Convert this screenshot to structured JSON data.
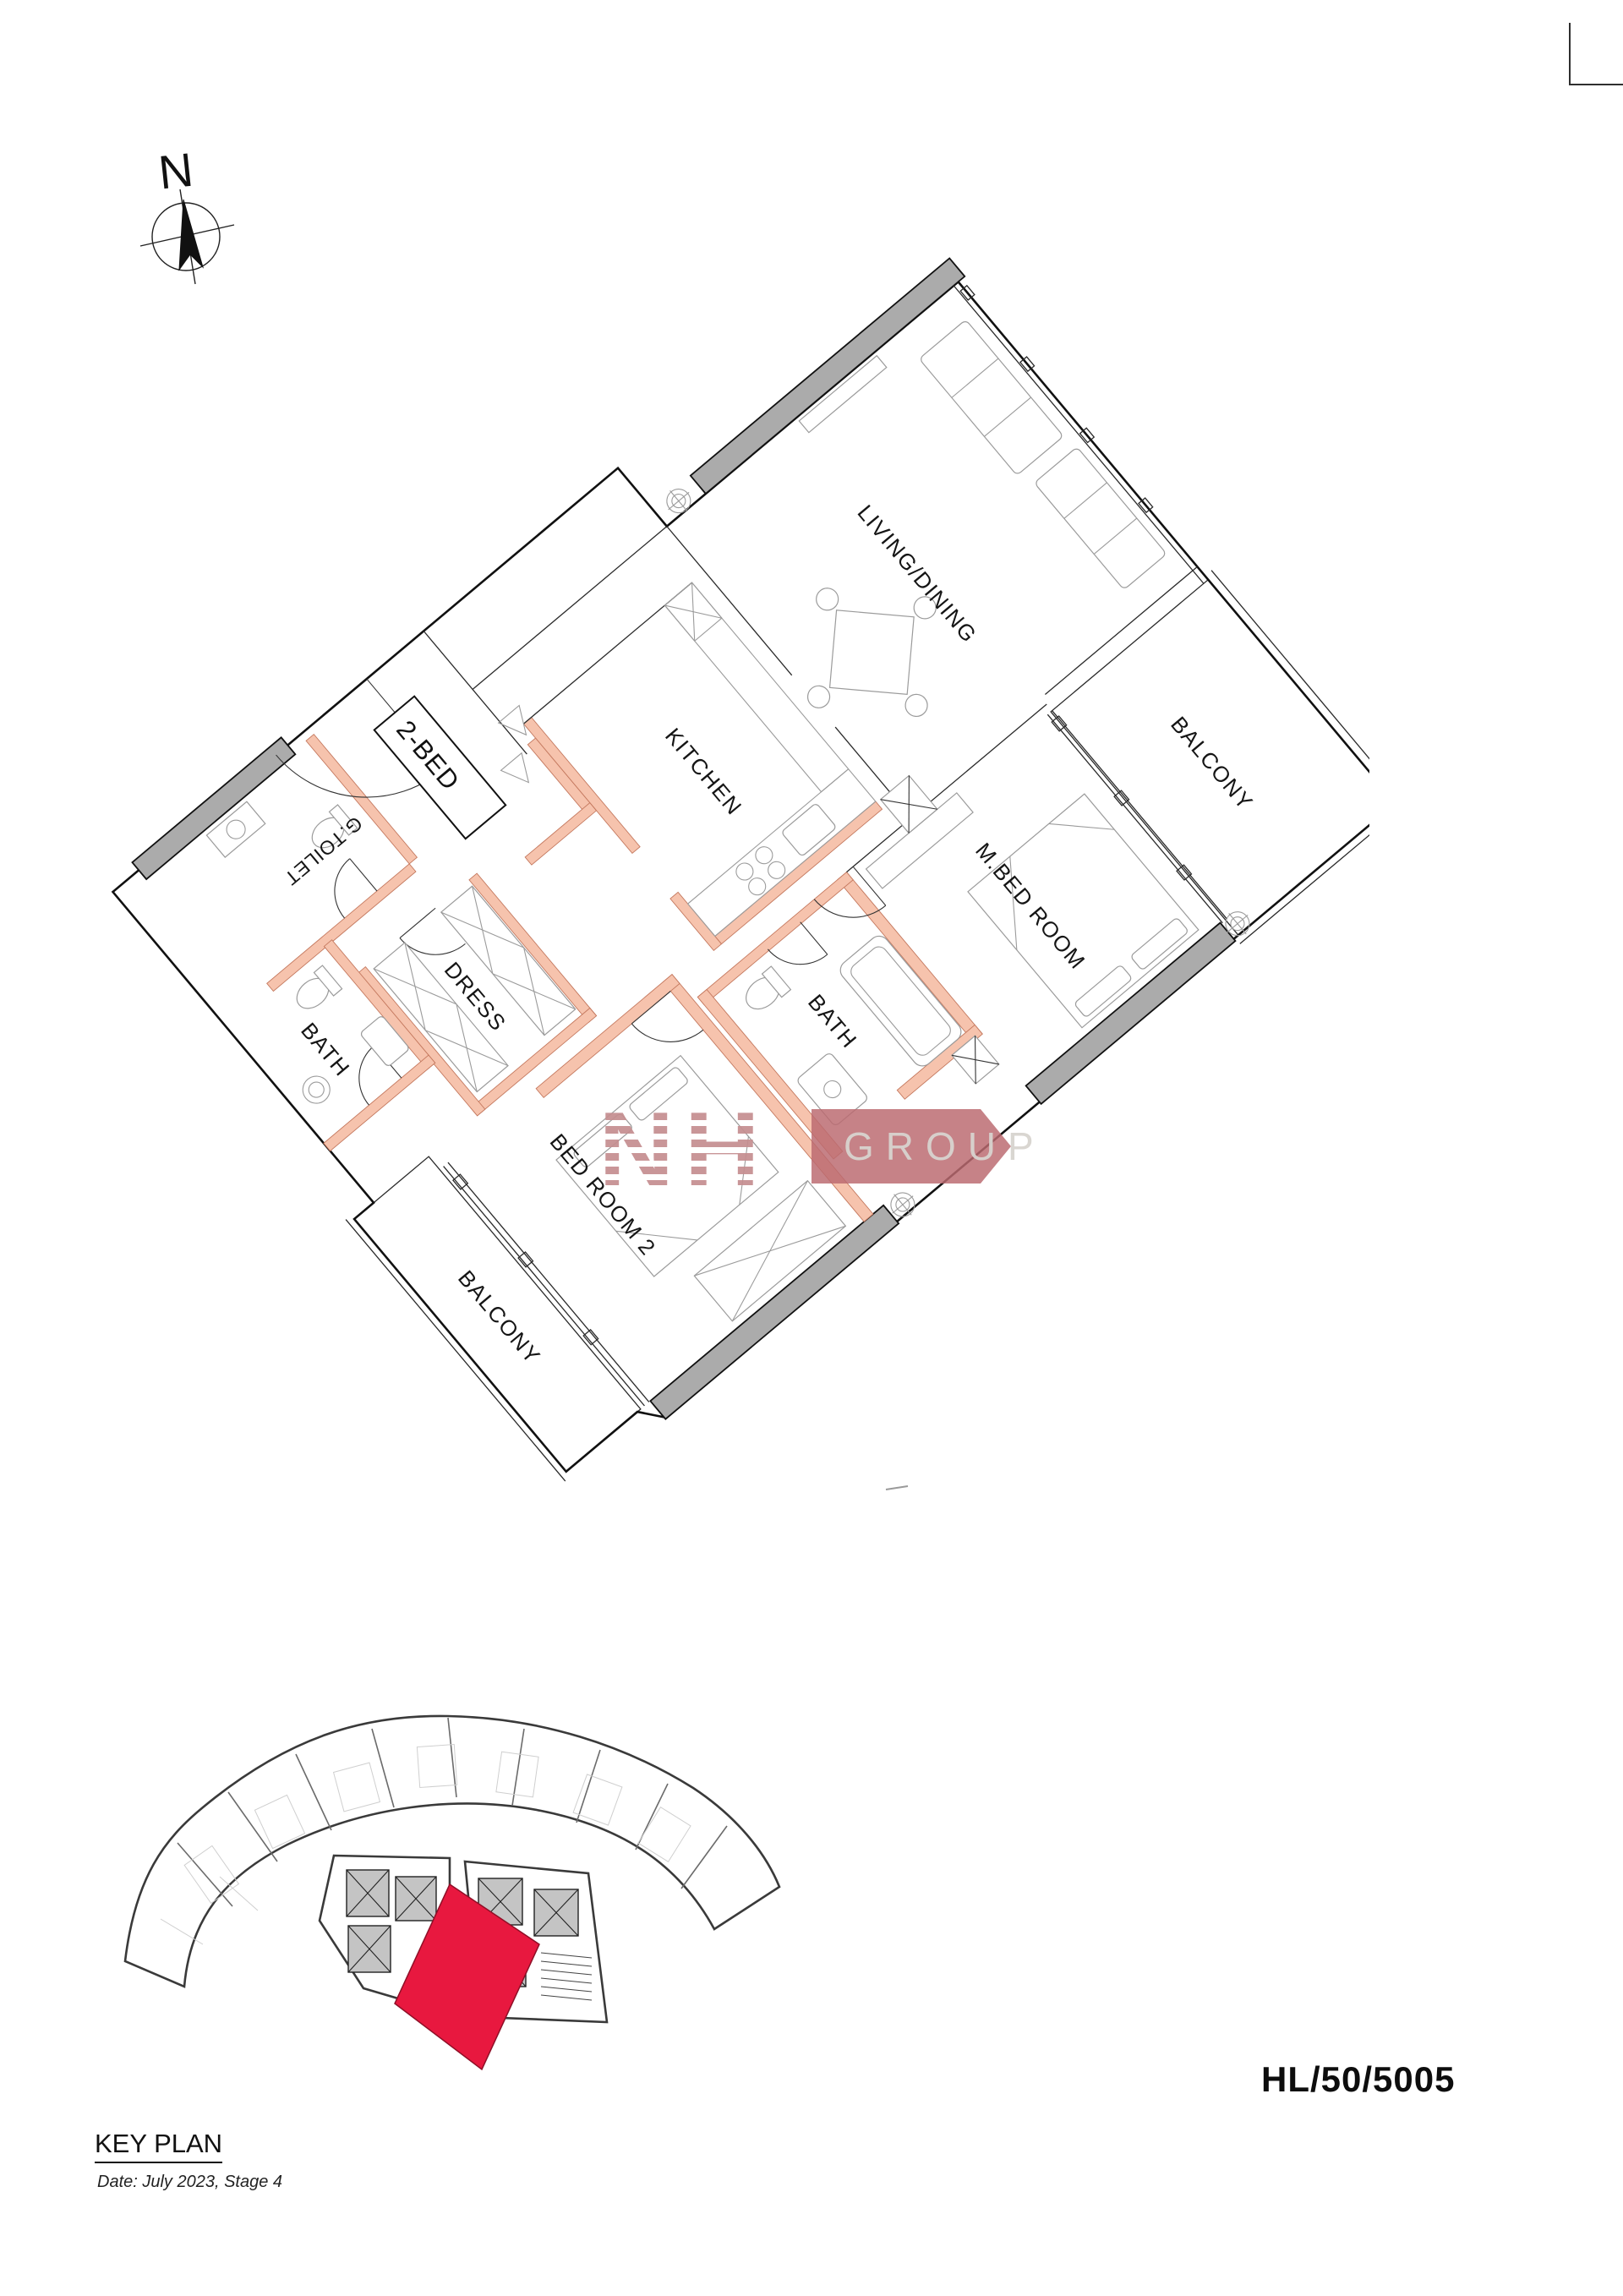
{
  "document": {
    "unit_code": "HL/50/5005",
    "key_plan_title": "KEY PLAN",
    "key_plan_date": "Date: July 2023, Stage 4"
  },
  "compass": {
    "label": "N"
  },
  "floor_plan": {
    "unit_type_label": "2-BED",
    "room_labels": {
      "living_dining": "LIVING/DINING",
      "kitchen": "KITCHEN",
      "master_bedroom": "M.BED ROOM",
      "balcony_right": "BALCONY",
      "master_bath": "BATH",
      "dress": "DRESS",
      "guest_toilet": "G.TOILET",
      "guest_bath": "BATH",
      "bedroom2": "BED ROOM 2",
      "balcony_bottom": "BALCONY"
    }
  },
  "watermark": {
    "monogram": "NH",
    "word": "GROUP"
  },
  "colors": {
    "exterior_wall": "#ababab",
    "partition_wall": "#f6c3ad",
    "highlight_unit_red": "#e8183f",
    "watermark_rose": "#c58e90",
    "watermark_box": "#bb6a70"
  }
}
